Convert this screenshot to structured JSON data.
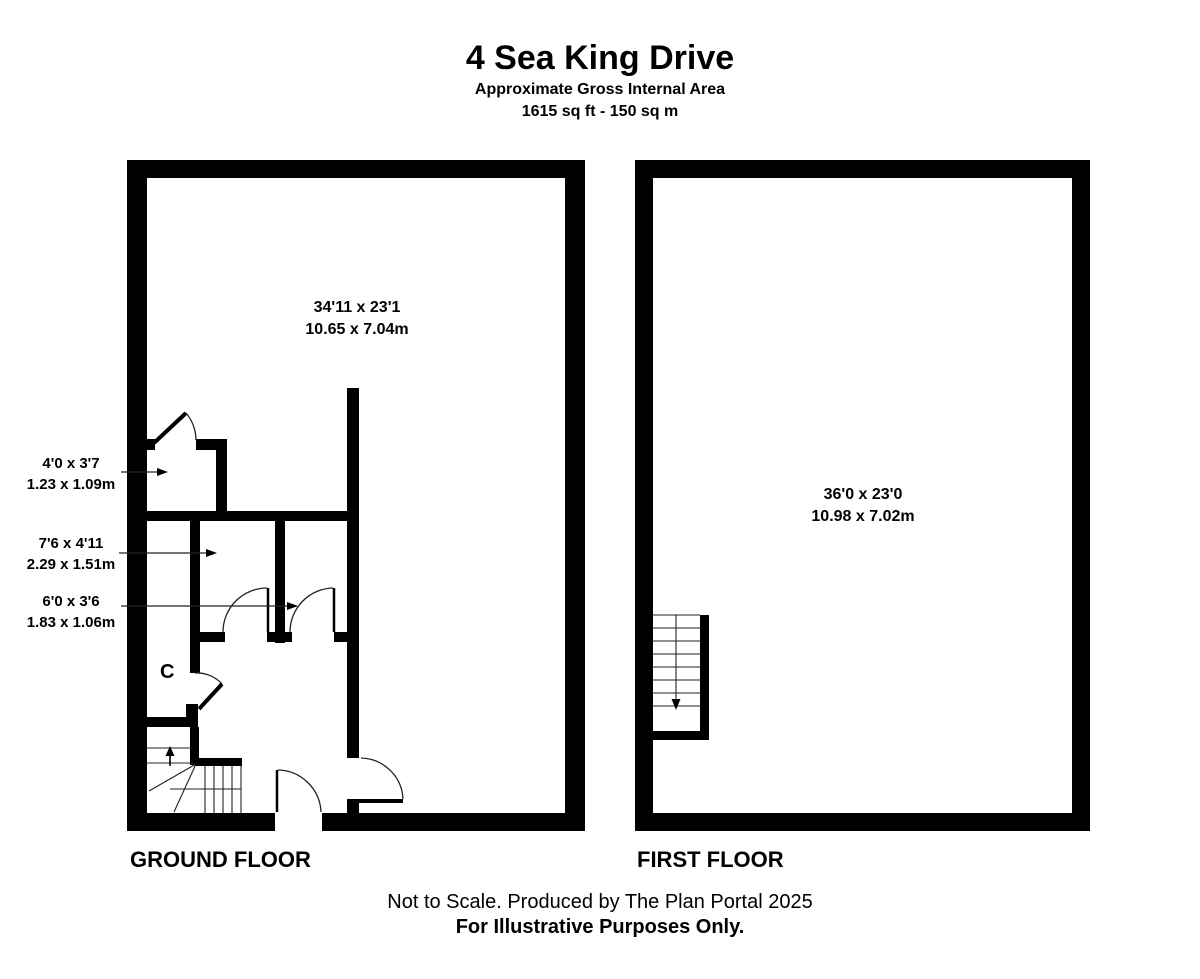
{
  "header": {
    "title": "4 Sea King Drive",
    "subtitle": "Approximate Gross Internal Area",
    "area": "1615 sq ft - 150 sq m"
  },
  "ground_floor": {
    "label": "GROUND FLOOR",
    "main_room": {
      "imperial": "34'11 x 23'1",
      "metric": "10.65 x 7.04m"
    },
    "cupboard_label": "C",
    "side_rooms": [
      {
        "imperial": "4'0 x 3'7",
        "metric": "1.23 x 1.09m"
      },
      {
        "imperial": "7'6 x 4'11",
        "metric": "2.29 x 1.51m"
      },
      {
        "imperial": "6'0 x 3'6",
        "metric": "1.83 x 1.06m"
      }
    ]
  },
  "first_floor": {
    "label": "FIRST FLOOR",
    "main_room": {
      "imperial": "36'0 x 23'0",
      "metric": "10.98 x 7.02m"
    }
  },
  "footer": {
    "line1": "Not to Scale. Produced by The Plan Portal 2025",
    "line2": "For Illustrative Purposes Only."
  },
  "colors": {
    "wall": "#000000",
    "background": "#ffffff",
    "text": "#000000",
    "thin_line": "#222222"
  }
}
